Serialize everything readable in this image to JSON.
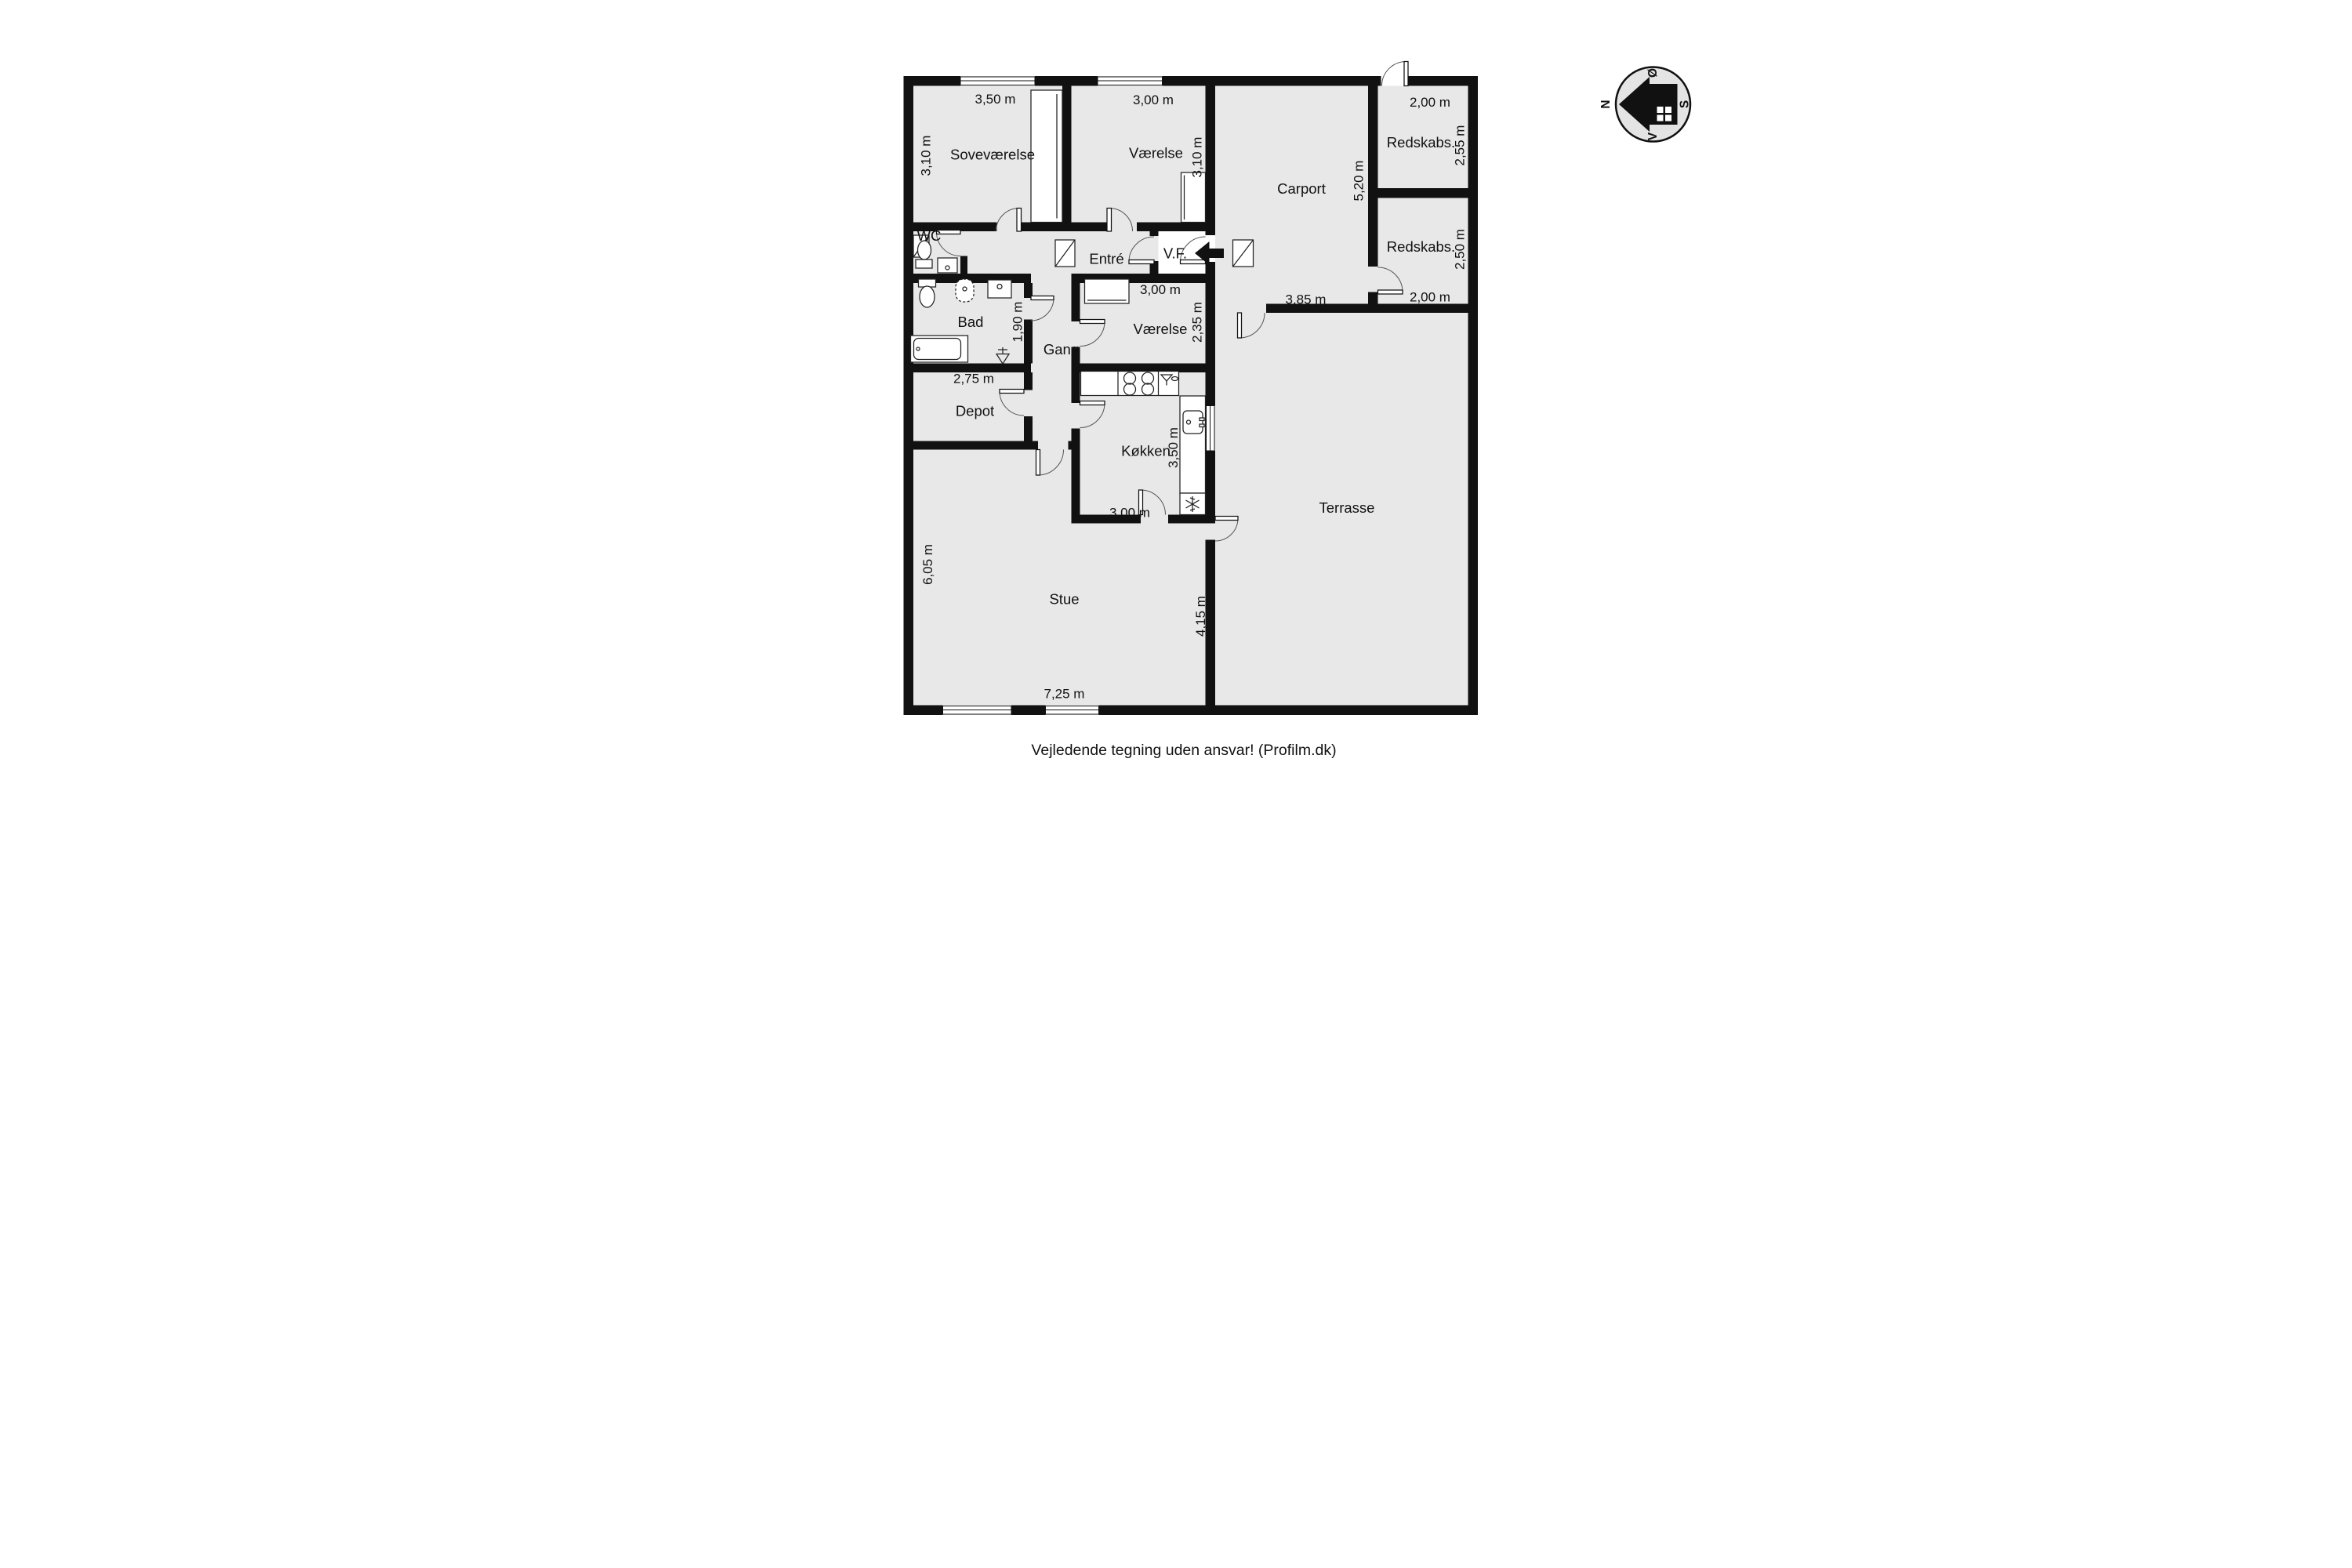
{
  "floorplan": {
    "rooms": {
      "sovevaerelse": {
        "name": "Soveværelse",
        "dim_w": "3,50 m",
        "dim_h": "3,10 m"
      },
      "vaerelse_top": {
        "name": "Værelse",
        "dim_w": "3,00 m",
        "dim_h": "3,10 m"
      },
      "carport": {
        "name": "Carport",
        "dim_w": "3,85 m",
        "dim_h": "5,20 m"
      },
      "redskabs_top": {
        "name": "Redskabs.",
        "dim_w": "2,00 m",
        "dim_h": "2,55 m"
      },
      "redskabs_bottom": {
        "name": "Redskabs.",
        "dim_w": "2,00 m",
        "dim_h": "2,50 m"
      },
      "wc": {
        "name": "WC"
      },
      "bad": {
        "name": "Bad"
      },
      "gang": {
        "name": "Gang",
        "dim_h": "1,90 m"
      },
      "entre": {
        "name": "Entré"
      },
      "vf": {
        "name": "V.F."
      },
      "vaerelse_mid": {
        "name": "Værelse",
        "dim_w": "3,00 m",
        "dim_h": "2,35 m"
      },
      "depot": {
        "name": "Depot",
        "dim_w": "2,75 m"
      },
      "koekken": {
        "name": "Køkken",
        "dim_w": "3,00 m",
        "dim_h": "3,50 m"
      },
      "stue": {
        "name": "Stue",
        "dim_w": "7,25 m",
        "dim_h": "6,05 m"
      },
      "terrasse": {
        "name": "Terrasse",
        "dim_h": "4,15 m"
      }
    },
    "compass": {
      "north": "N",
      "east": "Ø",
      "south": "S",
      "west": "V"
    },
    "footer": "Vejledende tegning uden ansvar! (Profilm.dk)",
    "colors": {
      "floor": "#e8e8e8",
      "wall": "#111111",
      "background": "#ffffff"
    }
  }
}
